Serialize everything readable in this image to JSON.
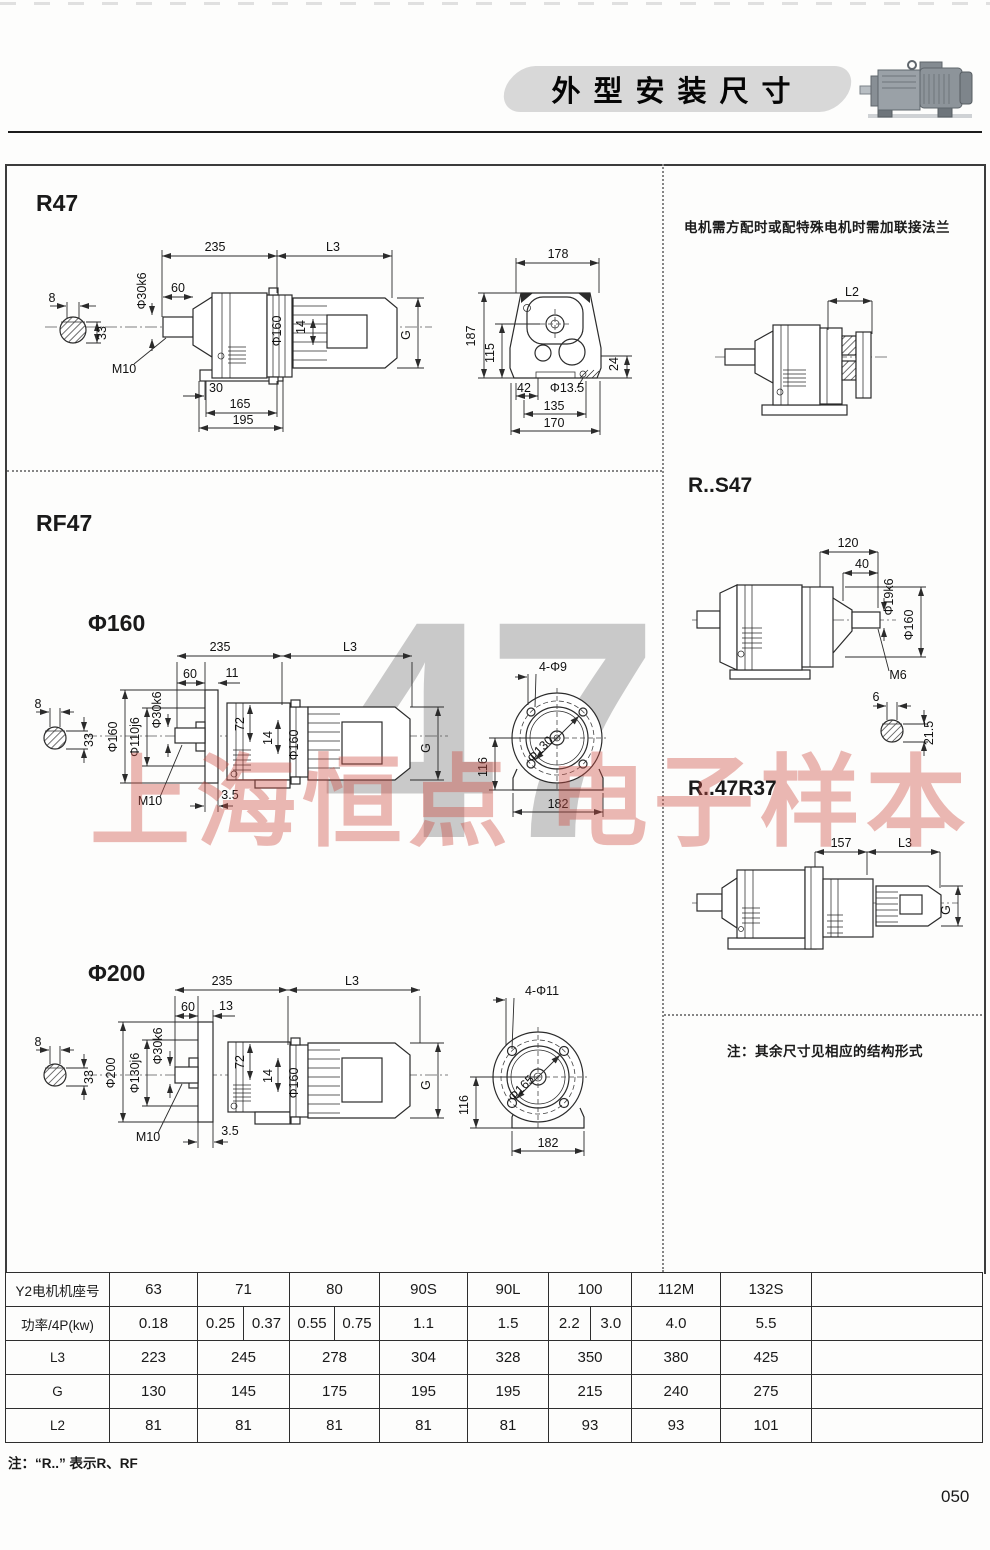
{
  "header": {
    "title": "外型安装尺寸"
  },
  "watermark": {
    "numeral": "47",
    "banner": "上海恒点 电子样本"
  },
  "drawings": {
    "r47": {
      "title": "R47",
      "side": {
        "w235": "235",
        "l3": "L3",
        "w60": "60",
        "shaft": "Φ30k6",
        "keyW": "8",
        "keyH": "33",
        "tap": "M10",
        "flange": "Φ160",
        "k14": "14",
        "g": "G",
        "w30": "30",
        "w165": "165",
        "w195": "195"
      },
      "front": {
        "w178": "178",
        "h187": "187",
        "h115": "115",
        "h24": "24",
        "w42": "42",
        "hole": "Φ13.5",
        "w135": "135",
        "w170": "170"
      }
    },
    "flange_panel": {
      "note": "电机需方配时或配特殊电机时需加联接法兰",
      "l2": "L2"
    },
    "rf47": {
      "title": "RF47"
    },
    "rf160": {
      "title": "Φ160",
      "side": {
        "w235": "235",
        "l3": "L3",
        "w60": "60",
        "w11": "11",
        "shaft": "Φ30k6",
        "spigot": "Φ110j6",
        "flange": "Φ160",
        "keyW": "8",
        "keyH": "33",
        "h72": "72",
        "k14": "14",
        "d160": "Φ160",
        "g": "G",
        "tap": "M10",
        "t35": "3.5"
      },
      "front": {
        "holes": "4-Φ9",
        "bolt_circle": "Φ130",
        "h116": "116",
        "w182": "182"
      }
    },
    "rf200": {
      "title": "Φ200",
      "side": {
        "w235": "235",
        "l3": "L3",
        "w60": "60",
        "w13": "13",
        "shaft": "Φ30k6",
        "spigot": "Φ130j6",
        "flange": "Φ200",
        "keyW": "8",
        "keyH": "33",
        "h72": "72",
        "k14": "14",
        "d160": "Φ160",
        "g": "G",
        "tap": "M10",
        "t35": "3.5"
      },
      "front": {
        "holes": "4-Φ11",
        "bolt_circle": "Φ165",
        "h116": "116",
        "w182": "182"
      }
    },
    "rs47": {
      "title": "R..S47",
      "w120": "120",
      "w40": "40",
      "shaft": "Φ19k6",
      "d160": "Φ160",
      "tap": "M6",
      "keyW": "6",
      "keyH": "21.5"
    },
    "r47r37": {
      "title": "R..47R37",
      "w157": "157",
      "l3": "L3",
      "g": "G"
    },
    "note": "注：其余尺寸见相应的结构形式"
  },
  "table": {
    "y2": {
      "label": "Y2电机机座号",
      "values": [
        "63",
        "71",
        "80",
        "90S",
        "90L",
        "100",
        "112M",
        "132S"
      ]
    },
    "power": {
      "label": "功率/4P(kw)",
      "v63": "0.18",
      "v71a": "0.25",
      "v71b": "0.37",
      "v80a": "0.55",
      "v80b": "0.75",
      "v90s": "1.1",
      "v90l": "1.5",
      "v100a": "2.2",
      "v100b": "3.0",
      "v112m": "4.0",
      "v132s": "5.5"
    },
    "l3": {
      "label": "L3",
      "values": [
        "223",
        "245",
        "278",
        "304",
        "328",
        "350",
        "380",
        "425"
      ]
    },
    "g": {
      "label": "G",
      "values": [
        "130",
        "145",
        "175",
        "195",
        "195",
        "215",
        "240",
        "275"
      ]
    },
    "l2": {
      "label": "L2",
      "values": [
        "81",
        "81",
        "81",
        "81",
        "81",
        "93",
        "93",
        "101"
      ]
    }
  },
  "footnote": "注：“R..” 表示R、RF",
  "page_number": "050"
}
